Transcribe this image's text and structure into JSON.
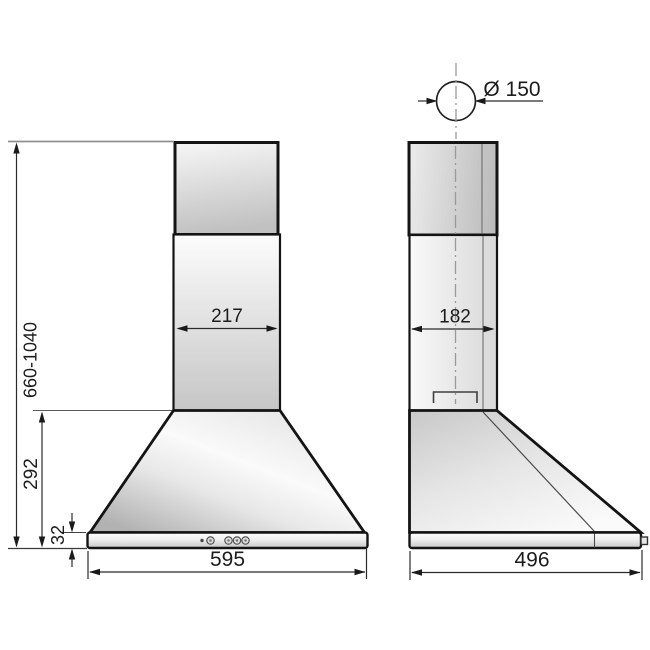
{
  "diagram_type": "cooker-hood-installation-drawing",
  "front_view": {
    "chimney_width": "217",
    "hood_width": "595",
    "height_range": "660-1040",
    "cone_height": "292",
    "base_thickness": "32"
  },
  "side_view": {
    "duct_diameter": "Ø 150",
    "chimney_depth": "182",
    "hood_depth": "496"
  },
  "colors": {
    "background": "#ffffff",
    "outline": "#141414",
    "dimension_line": "#2a2a2a",
    "centerline": "#9a9a9a",
    "body_fill_light": "#f7f7f7",
    "body_fill_dark": "#c1c1c1"
  }
}
